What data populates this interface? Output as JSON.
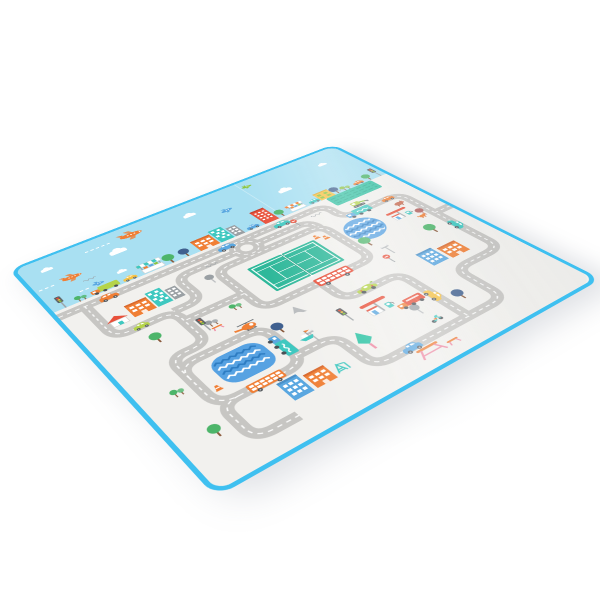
{
  "caption": "Foldable baby play mat with a cartoon city road-map design, photographed at an angle on a white background",
  "palette": {
    "bg": "#ffffff",
    "edge": "#3fc0f0",
    "edge-light": "#8edcf6",
    "sky": "#a9e0f2",
    "ground": "#f2f1ee",
    "road": "#c7c6c3",
    "roadline": "#ffffff",
    "green": "#2eb89a",
    "green-dark": "#23a183",
    "field": "#35c2a4",
    "field-line": "#27ab8e",
    "water": "#57a2e2",
    "water-dark": "#2d7cc2",
    "red": "#e8503a",
    "orange": "#f07f35",
    "yellow": "#f6c245",
    "lime": "#b5d44a",
    "teal": "#3fc8c0",
    "blue": "#5aa7e0",
    "navy": "#40608f",
    "leaf": "#4db56a",
    "pink": "#ef8aa4",
    "brown": "#8a5a3c",
    "gray": "#9aa0a4",
    "dark": "#555a5e",
    "white": "#ffffff",
    "wine": "#b4625f"
  },
  "mat": {
    "areas": [
      "sky band with aircraft",
      "city with gray road maze"
    ],
    "objects": [
      "orange airplane with dashed trail",
      "small blue plane",
      "small green plane",
      "clouds",
      "skyline row of shops, houses, towers, trees and cars",
      "roundabout",
      "tennis court",
      "round swimming pool with waves",
      "wavy pond",
      "green striped field",
      "gas station with red canopy",
      "second fuel pump station",
      "red double-decker bus",
      "orange bus",
      "teal delivery trucks",
      "race car",
      "excavator",
      "helicopter",
      "sail boat",
      "scooter",
      "assorted cars",
      "apartment buildings (orange, teal, blue, red, yellow, gray)",
      "red-roof house",
      "round trees, twin bushes, teal pine tree, dandelion trees",
      "traffic lights",
      "no-entry signs",
      "traffic cones",
      "street lamps",
      "gray arrow marker",
      "picnic table and bench",
      "climbing frame",
      "farm animals"
    ],
    "edge_style": "rounded corners with bright blue piping",
    "decorative": {
      "squiggle_marks": 4,
      "plane_trail_dashes": true,
      "fold_seam": true
    }
  }
}
